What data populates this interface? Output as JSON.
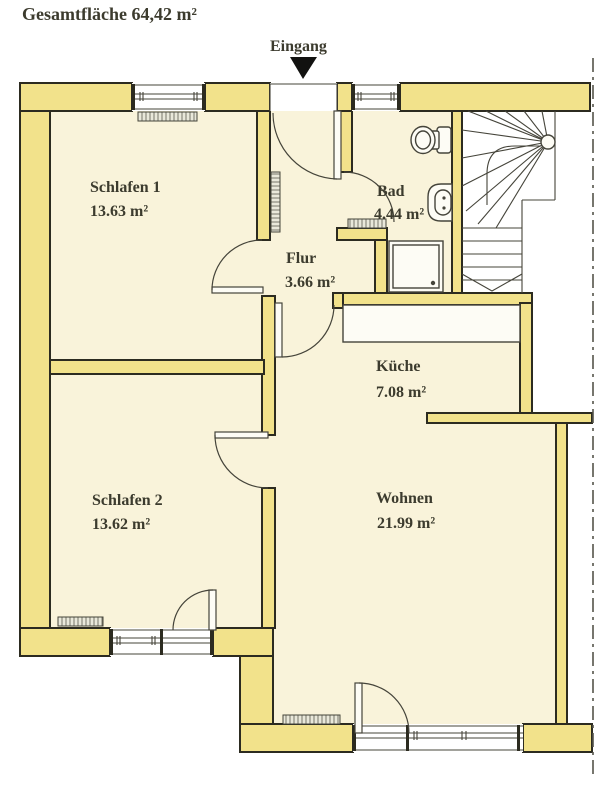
{
  "title": "Gesamtfläche 64,42 m²",
  "entrance": {
    "label": "Eingang"
  },
  "rooms": [
    {
      "name": "Schlafen 1",
      "area": "13.63 m²"
    },
    {
      "name": "Schlafen 2",
      "area": "13.62 m²"
    },
    {
      "name": "Flur",
      "area": "3.66 m²"
    },
    {
      "name": "Bad",
      "area": "4.44 m²"
    },
    {
      "name": "Küche",
      "area": "7.08 m²"
    },
    {
      "name": "Wohnen",
      "area": "21.99 m²"
    }
  ],
  "fixtures": [
    "toilet",
    "washbasin",
    "shower",
    "staircase",
    "kitchen-counter",
    "radiator",
    "entrance-arrow",
    "property-boundary-line"
  ],
  "colors": {
    "wall": "#f2e28b",
    "floor": "#f9f3da",
    "outline": "#2c2b20",
    "text": "#3c3b2e"
  }
}
